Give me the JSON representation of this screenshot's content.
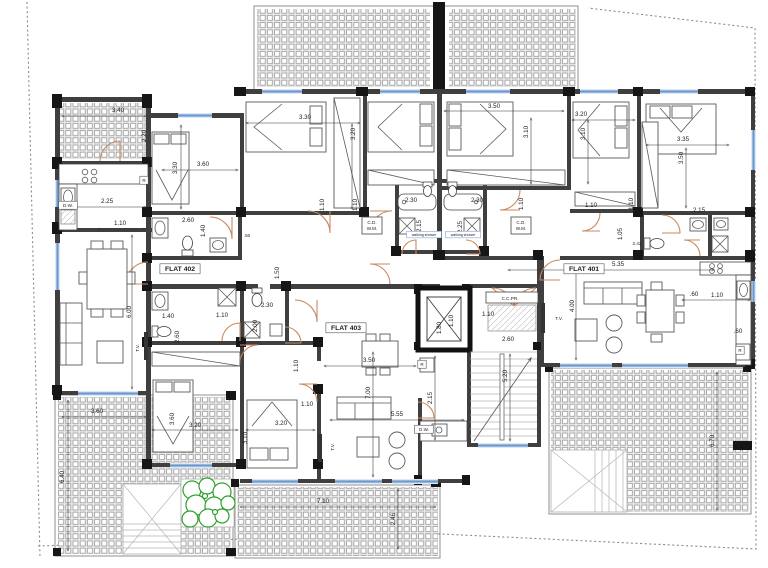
{
  "drawing": {
    "flat_labels": [
      "FLAT 402",
      "FLAT 401",
      "FLAT 403"
    ],
    "colors": {
      "wall": "#3f3f3f",
      "column": "#161616",
      "window": "#6c98d0",
      "door_swing": "#c98a63",
      "plants": "#2da02d",
      "tile_line": "#9a9a9a",
      "dimension_text": "#1c1c1c"
    }
  },
  "labels": [
    {
      "t": "3.40",
      "x": 118,
      "y": 112
    },
    {
      "t": "2.20",
      "x": 146,
      "y": 136,
      "r": 1
    },
    {
      "t": "2.25",
      "x": 107,
      "y": 203
    },
    {
      "t": "1.10",
      "x": 120,
      "y": 225
    },
    {
      "t": "6.00",
      "x": 131,
      "y": 312,
      "r": 1
    },
    {
      "t": "T.V.",
      "x": 139,
      "y": 348,
      "r": 1,
      "s": 1
    },
    {
      "t": "3.30",
      "x": 177,
      "y": 168,
      "r": 1
    },
    {
      "t": "3.60",
      "x": 203,
      "y": 166
    },
    {
      "t": "2.60",
      "x": 188,
      "y": 222
    },
    {
      "t": "1.40",
      "x": 205,
      "y": 231,
      "r": 1
    },
    {
      "t": ".50",
      "x": 247,
      "y": 237,
      "s": 1
    },
    {
      "t": "FLAT 402",
      "x": 180,
      "y": 271,
      "b": 1,
      "f": 1
    },
    {
      "t": "1.50",
      "x": 279,
      "y": 273,
      "r": 1
    },
    {
      "t": "3.30",
      "x": 305,
      "y": 119
    },
    {
      "t": "3.20",
      "x": 355,
      "y": 134,
      "r": 1
    },
    {
      "t": "1.10",
      "x": 324,
      "y": 205,
      "r": 1
    },
    {
      "t": "1.10",
      "x": 357,
      "y": 205,
      "r": 1
    },
    {
      "t": "C.D.",
      "x": 372,
      "y": 224,
      "s": 1
    },
    {
      "t": "W.M.",
      "x": 372,
      "y": 230,
      "s": 1
    },
    {
      "t": "2.30",
      "x": 411,
      "y": 202
    },
    {
      "t": "2.15",
      "x": 421,
      "y": 226,
      "r": 1
    },
    {
      "t": "walking shower",
      "x": 424,
      "y": 236,
      "ws": 1
    },
    {
      "t": "2.30",
      "x": 477,
      "y": 202
    },
    {
      "t": "2.25",
      "x": 462,
      "y": 227,
      "r": 1
    },
    {
      "t": "walking shower",
      "x": 463,
      "y": 236,
      "ws": 1
    },
    {
      "t": "3.50",
      "x": 494,
      "y": 108
    },
    {
      "t": "3.10",
      "x": 528,
      "y": 132,
      "r": 1
    },
    {
      "t": "1.10",
      "x": 523,
      "y": 204,
      "r": 1
    },
    {
      "t": "3.20",
      "x": 581,
      "y": 116
    },
    {
      "t": "3.10",
      "x": 585,
      "y": 134,
      "r": 1
    },
    {
      "t": "1.10",
      "x": 591,
      "y": 207
    },
    {
      "t": "1.10",
      "x": 633,
      "y": 204,
      "r": 1
    },
    {
      "t": "C.D.",
      "x": 521,
      "y": 224,
      "s": 1
    },
    {
      "t": "W.M.",
      "x": 521,
      "y": 230,
      "s": 1
    },
    {
      "t": "3.35",
      "x": 683,
      "y": 141
    },
    {
      "t": "3.50",
      "x": 683,
      "y": 158,
      "r": 1
    },
    {
      "t": "2.15",
      "x": 699,
      "y": 212
    },
    {
      "t": "1.05",
      "x": 622,
      "y": 234,
      "r": 1
    },
    {
      "t": "2.43",
      "x": 637,
      "y": 245,
      "s": 1
    },
    {
      "t": "FLAT 401",
      "x": 584,
      "y": 271,
      "b": 1,
      "f": 1
    },
    {
      "t": "5.35",
      "x": 618,
      "y": 266
    },
    {
      "t": ".60",
      "x": 694,
      "y": 296
    },
    {
      "t": "1.10",
      "x": 717,
      "y": 297
    },
    {
      "t": ".60",
      "x": 738,
      "y": 333
    },
    {
      "t": "R",
      "x": 740,
      "y": 352,
      "s": 1,
      "b": 1
    },
    {
      "t": "4.00",
      "x": 574,
      "y": 306,
      "r": 1
    },
    {
      "t": "T.V.",
      "x": 559,
      "y": 320,
      "s": 1
    },
    {
      "t": "2.60",
      "x": 508,
      "y": 341
    },
    {
      "t": "1.10",
      "x": 488,
      "y": 316
    },
    {
      "t": "1.80",
      "x": 441,
      "y": 328,
      "r": 1
    },
    {
      "t": "1.10",
      "x": 453,
      "y": 321,
      "r": 1
    },
    {
      "t": "C.C.PR.",
      "x": 510,
      "y": 300,
      "s": 1
    },
    {
      "t": "5.20",
      "x": 507,
      "y": 376,
      "r": 1
    },
    {
      "t": "2.15",
      "x": 432,
      "y": 398,
      "r": 1
    },
    {
      "t": "5.55",
      "x": 397,
      "y": 416
    },
    {
      "t": "R",
      "x": 422,
      "y": 366,
      "s": 1,
      "b": 1
    },
    {
      "t": "D.W.",
      "x": 424,
      "y": 431,
      "s": 1,
      "b": 1
    },
    {
      "t": "3.50",
      "x": 369,
      "y": 362
    },
    {
      "t": "7.00",
      "x": 370,
      "y": 393,
      "r": 1
    },
    {
      "t": "1.10",
      "x": 307,
      "y": 406
    },
    {
      "t": "FLAT 403",
      "x": 346,
      "y": 330,
      "b": 1,
      "f": 1
    },
    {
      "t": "1.40",
      "x": 168,
      "y": 318
    },
    {
      "t": "1.10",
      "x": 222,
      "y": 317
    },
    {
      "t": "2.60",
      "x": 179,
      "y": 337,
      "r": 1
    },
    {
      "t": "2.30",
      "x": 267,
      "y": 307
    },
    {
      "t": "2.00",
      "x": 257,
      "y": 326,
      "r": 1
    },
    {
      "t": "1.10",
      "x": 298,
      "y": 366,
      "r": 1
    },
    {
      "t": "R",
      "x": 144,
      "y": 182,
      "s": 1,
      "b": 1
    },
    {
      "t": "D.W.",
      "x": 68,
      "y": 207,
      "s": 1,
      "b": 1
    },
    {
      "t": "3.60",
      "x": 174,
      "y": 419,
      "r": 1
    },
    {
      "t": "3.20",
      "x": 195,
      "y": 427
    },
    {
      "t": "3.10",
      "x": 247,
      "y": 438,
      "r": 1
    },
    {
      "t": "3.20",
      "x": 281,
      "y": 425
    },
    {
      "t": "T.V.",
      "x": 334,
      "y": 447,
      "s": 1,
      "r": 1
    },
    {
      "t": "3.60",
      "x": 97,
      "y": 413
    },
    {
      "t": "6.40",
      "x": 64,
      "y": 477,
      "r": 1
    },
    {
      "t": "7.10",
      "x": 323,
      "y": 503
    },
    {
      "t": "2.46",
      "x": 395,
      "y": 519,
      "r": 1
    },
    {
      "t": "6.70",
      "x": 714,
      "y": 441,
      "r": 1
    }
  ]
}
